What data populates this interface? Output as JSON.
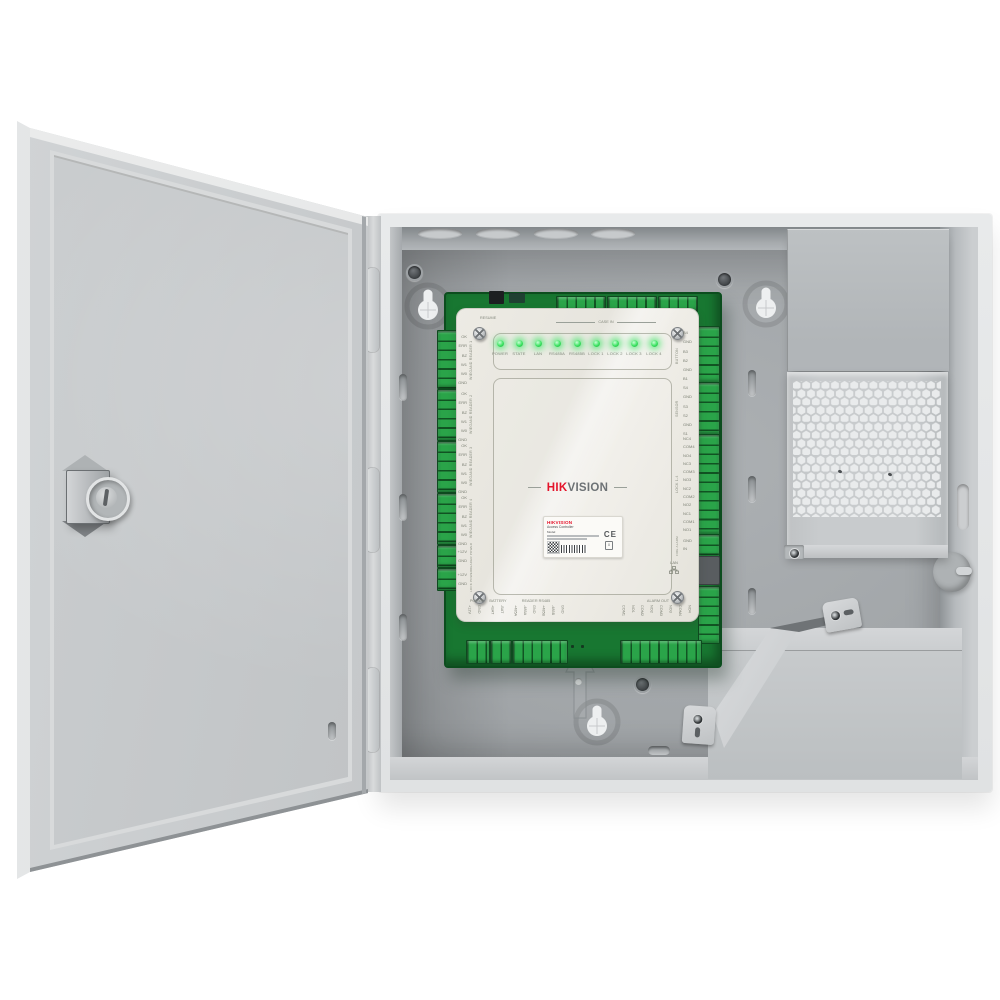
{
  "product": {
    "brand": "HIKVISION",
    "description": "Access controller board mounted inside wall-mount metal enclosure with open door, power supply cover and battery compartment"
  },
  "board": {
    "top_switch_label": "RESUME",
    "case_in_label": "CASE IN",
    "leds": [
      "POWER",
      "STATE",
      "LAN",
      "RS485A",
      "RS485B",
      "LOCK 1",
      "LOCK 2",
      "LOCK 3",
      "LOCK 4"
    ],
    "logo": {
      "hik": "HIK",
      "vision": "VISION"
    },
    "left_groups": [
      {
        "label": "WIEGAND READER 1",
        "pins": "OK\nERR\nBZ\nW1\nW0\nGND"
      },
      {
        "label": "WIEGAND READER 2",
        "pins": "OK\nERR\nBZ\nW1\nW0\nGND"
      },
      {
        "label": "WIEGAND READER 3",
        "pins": "OK\nERR\nBZ\nW1\nW0\nGND"
      },
      {
        "label": "WIEGAND READER 4",
        "pins": "OK\nERR\nBZ\nW1\nW0\nGND"
      },
      {
        "label": "READER POWER",
        "pins": "+12V\nGND"
      },
      {
        "label": "LOCK POWER",
        "pins": "+12V\nGND"
      }
    ],
    "right_groups": [
      {
        "label": "BUTTON",
        "pins": "B4\nGND\nB3\nB2\nGND\nB1"
      },
      {
        "label": "SENSOR",
        "pins": "S4\nGND\nS3\nS2\nGND\nS1"
      },
      {
        "label": "LOCK 1-4",
        "pins": "NC4\nCOM4\nNO4\nNC3\nCOM3\nNO3\nNC2\nCOM2\nNO2\nNC1\nCOM1\nNO1"
      },
      {
        "label": "FIRE ALARM",
        "pins": "GND\nIN"
      }
    ],
    "lan_label": "LAN",
    "bottom_groups": [
      {
        "label": "POWER",
        "pins": "+12V\nGND"
      },
      {
        "label": "BATTERY",
        "pins": "+BAT\n-BAT"
      },
      {
        "label": "READER RS485",
        "pins": "+485A\n-485A\nGND\n+485B\n-485B\nGND"
      },
      {
        "label": "ALARM OUT",
        "pins": "COM1\nNO1\nCOM2\nNO2\nCOM3\nNO3\nCOM4\nNO4"
      }
    ],
    "sticker": {
      "brand": "HIKVISION",
      "product": "Access Controller",
      "model_line": "Model:",
      "ce": "CE",
      "weee": "x"
    }
  },
  "colors": {
    "pcb_green": "#187731",
    "terminal_green": "#2aa449",
    "led_green": "#3ae260",
    "hik_red": "#e4142b",
    "cover_beige": "#e9e7e0",
    "enclosure_gray": "#c4c7c9",
    "backpanel_gray": "#a2a6a9"
  }
}
